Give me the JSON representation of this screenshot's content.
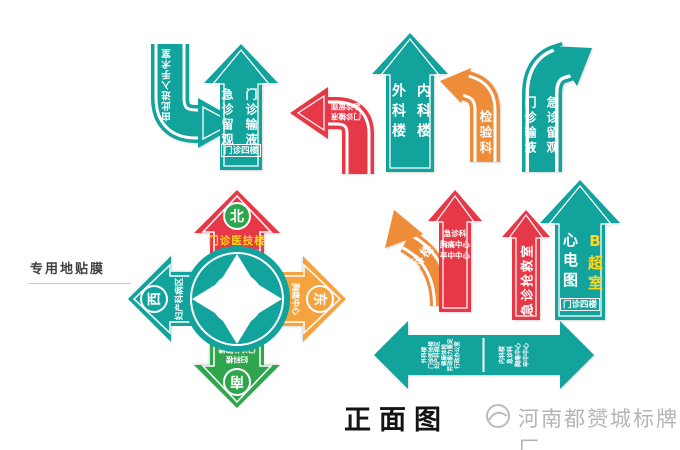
{
  "labels": {
    "note": "专用地贴膜",
    "view": "正面图",
    "watermark": "河南都赟城标牌厂"
  },
  "colors": {
    "teal": "#13a39d",
    "red": "#e73848",
    "orange": "#ef8c3a",
    "orange_light": "#f4a33f",
    "green": "#2fa54e",
    "yellow": "#ffd71c"
  },
  "signs": {
    "hook_arrow": {
      "text": "由此进入手术室"
    },
    "up1": {
      "left": "急诊留观",
      "right": "门诊输液",
      "floor": "门诊四楼"
    },
    "hook_red": {
      "line1": "门诊输液",
      "line2": "急诊留观"
    },
    "up2": {
      "left": "外科楼",
      "right": "内科楼"
    },
    "branch_orange": {
      "text": "检验科"
    },
    "branch_teal": {
      "left": "门诊输液",
      "right": "急诊留观"
    },
    "compass": {
      "north": {
        "dir": "北",
        "title": "门诊医技楼",
        "sub1": "（CT核磁 放射",
        "sub2": "彩超 化验）"
      },
      "east": {
        "dir": "东",
        "lines": [
          "胸痛中心",
          "急诊科",
          "卒中中心",
          "内科楼"
        ]
      },
      "south": {
        "dir": "南",
        "lines": [
          "妇科楼",
          "门诊住院楼",
          "住院部 入口",
          "餐厅 行政办公室"
        ]
      },
      "west": {
        "dir": "西",
        "lines": [
          "妇产科病区",
          "健康体检",
          "劳动能力鉴定"
        ]
      }
    },
    "curve_orange": {
      "text": "内科楼"
    },
    "up_red1": {
      "lines": [
        "急诊科",
        "胸痛中心",
        "卒中中心"
      ]
    },
    "up_red2": {
      "text": "急诊抢救室"
    },
    "up3": {
      "left": "心电图",
      "right": "B超室",
      "floor": "门诊四楼"
    },
    "double": {
      "left_lines": [
        "外科楼",
        "门诊医技楼",
        "妇产科病区",
        "健康体检",
        "劳动能力鉴定",
        "行政办公室"
      ],
      "right_lines": [
        "内科楼",
        "急诊科",
        "胸痛中心",
        "卒中中心"
      ]
    }
  }
}
